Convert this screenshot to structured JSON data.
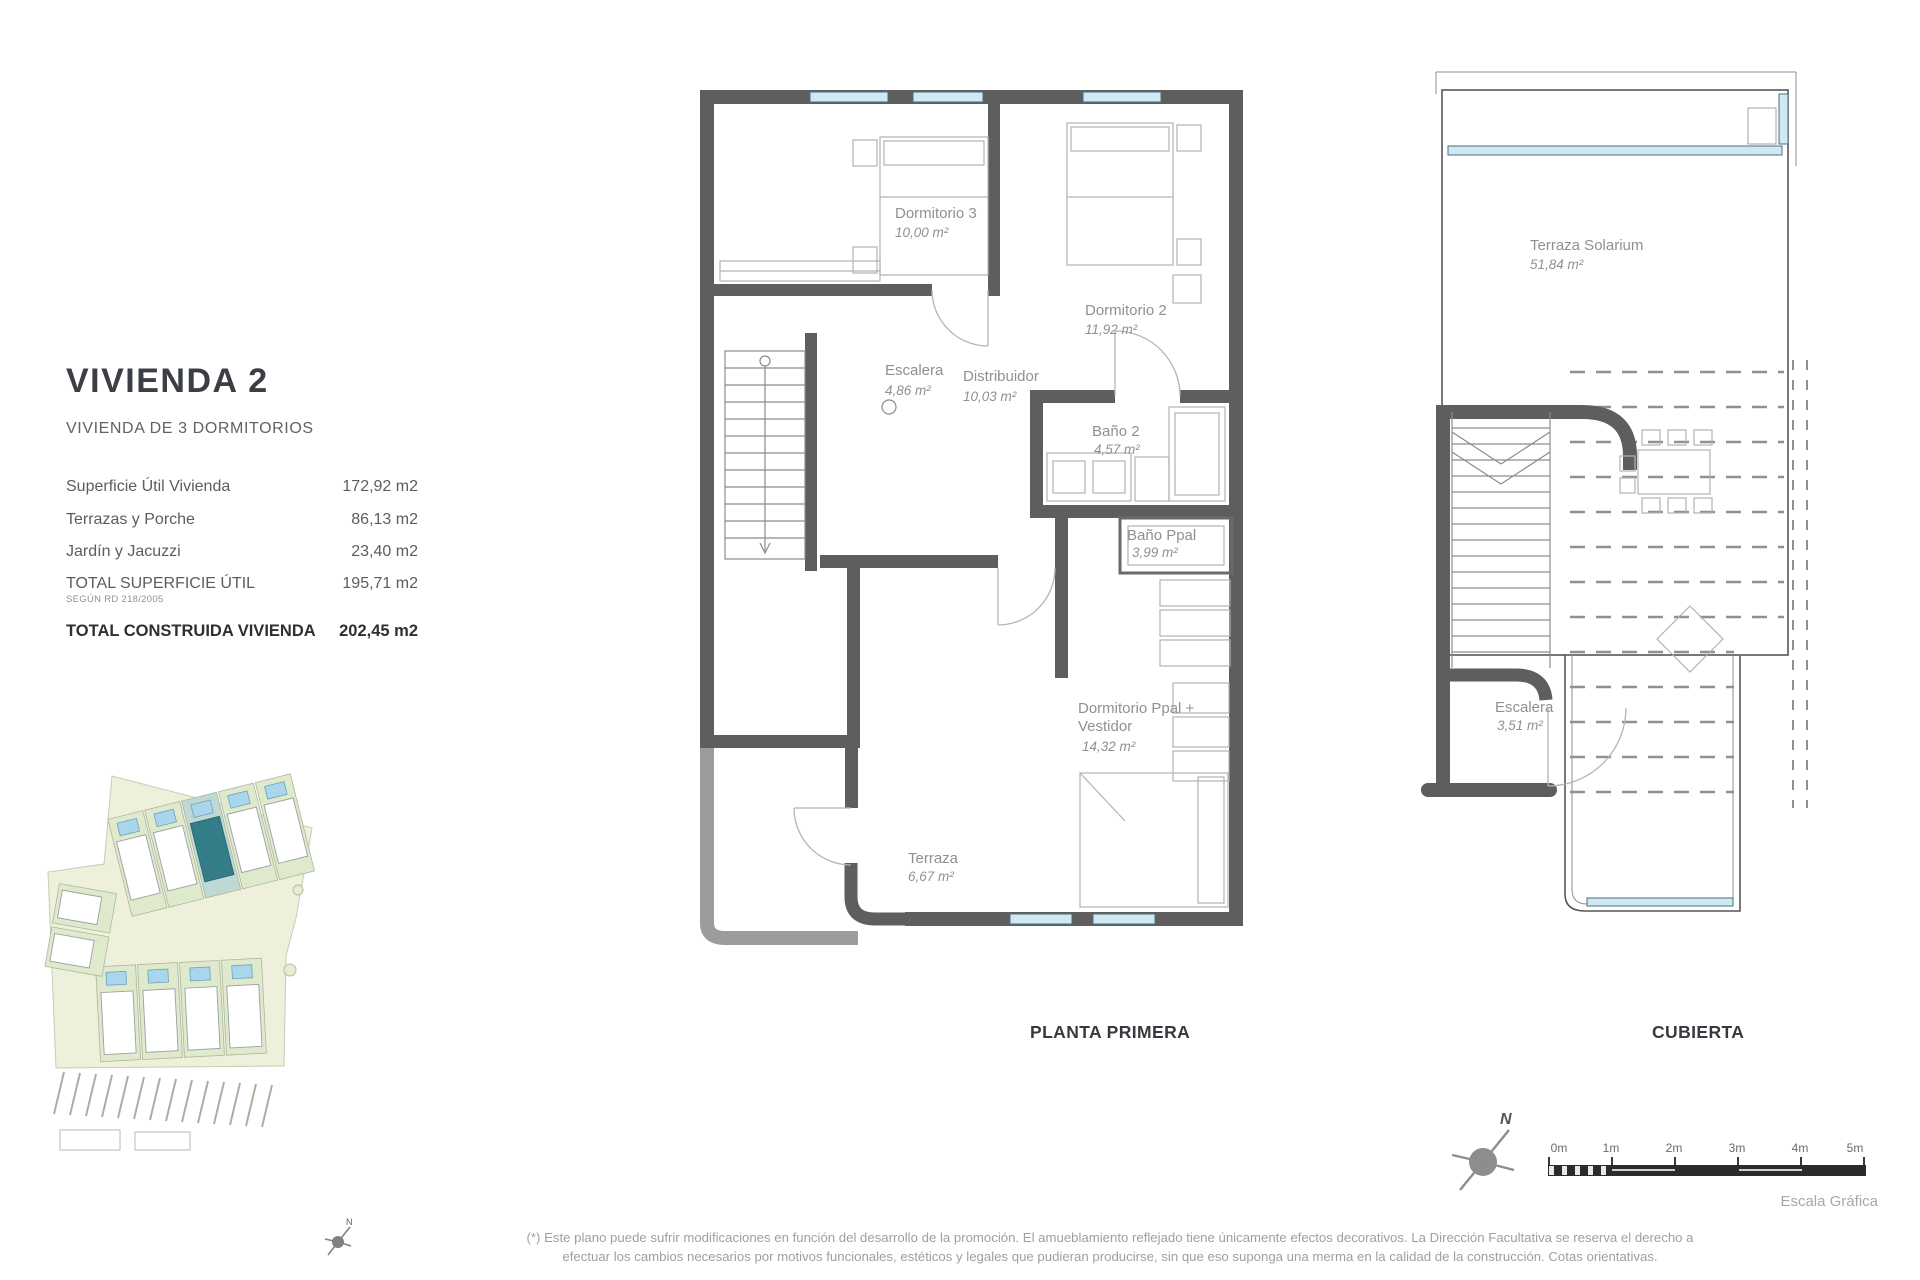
{
  "document": {
    "title": "VIVIENDA 2",
    "subtitle": "VIVIENDA DE 3 DORMITORIOS",
    "areas_table": {
      "rows": [
        {
          "label": "Superficie Útil Vivienda",
          "value": "172,92 m2"
        },
        {
          "label": "Terrazas y Porche",
          "value": "86,13 m2"
        },
        {
          "label": "Jardín y Jacuzzi",
          "value": "23,40 m2"
        },
        {
          "label": "TOTAL SUPERFICIE ÚTIL",
          "note": "SEGÚN RD 218/2005",
          "value": "195,71 m2"
        },
        {
          "label": "TOTAL CONSTRUIDA VIVIENDA",
          "value": "202,45 m2"
        }
      ]
    }
  },
  "plans": {
    "planta_primera": {
      "caption": "PLANTA PRIMERA",
      "rooms": {
        "dormitorio3": {
          "name": "Dormitorio 3",
          "area": "10,00 m²"
        },
        "dormitorio2": {
          "name": "Dormitorio 2",
          "area": "11,92 m²"
        },
        "escalera": {
          "name": "Escalera",
          "area": "4,86 m²"
        },
        "distribuidor": {
          "name": "Distribuidor",
          "area": "10,03 m²"
        },
        "bano2": {
          "name": "Baño 2",
          "area": "4,57 m²"
        },
        "bano_ppal": {
          "name": "Baño Ppal",
          "area": "3,99 m²"
        },
        "dormitorio_ppal": {
          "line1": "Dormitorio Ppal +",
          "line2": "Vestidor",
          "area": "14,32 m²"
        },
        "terraza": {
          "name": "Terraza",
          "area": "6,67 m²"
        }
      }
    },
    "cubierta": {
      "caption": "CUBIERTA",
      "rooms": {
        "terraza_solarium": {
          "name": "Terraza Solarium",
          "area": "51,84 m²"
        },
        "escalera": {
          "name": "Escalera",
          "area": "3,51 m²"
        }
      }
    }
  },
  "compass": {
    "north_label": "N"
  },
  "scale_bar": {
    "ticks": [
      "0m",
      "1m",
      "2m",
      "3m",
      "4m",
      "5m"
    ],
    "caption": "Escala Gráfica"
  },
  "footnote": {
    "line1": "(*) Este plano puede sufrir modificaciones en función del desarrollo de la promoción. El amueblamiento reflejado tiene únicamente efectos decorativos. La Dirección Facultativa se reserva el derecho a",
    "line2": "efectuar los cambios necesarios por motivos funcionales, estéticos y legales que pudieran producirse, sin que eso suponga una merma en la calidad de la construcción. Cotas orientativas."
  },
  "colors": {
    "wall_dark": "#5e5e5e",
    "wall_light": "#9c9c9c",
    "window_blue": "#cfe8f4",
    "highlight_teal": "#337d88",
    "label_gray": "#8e9194"
  }
}
